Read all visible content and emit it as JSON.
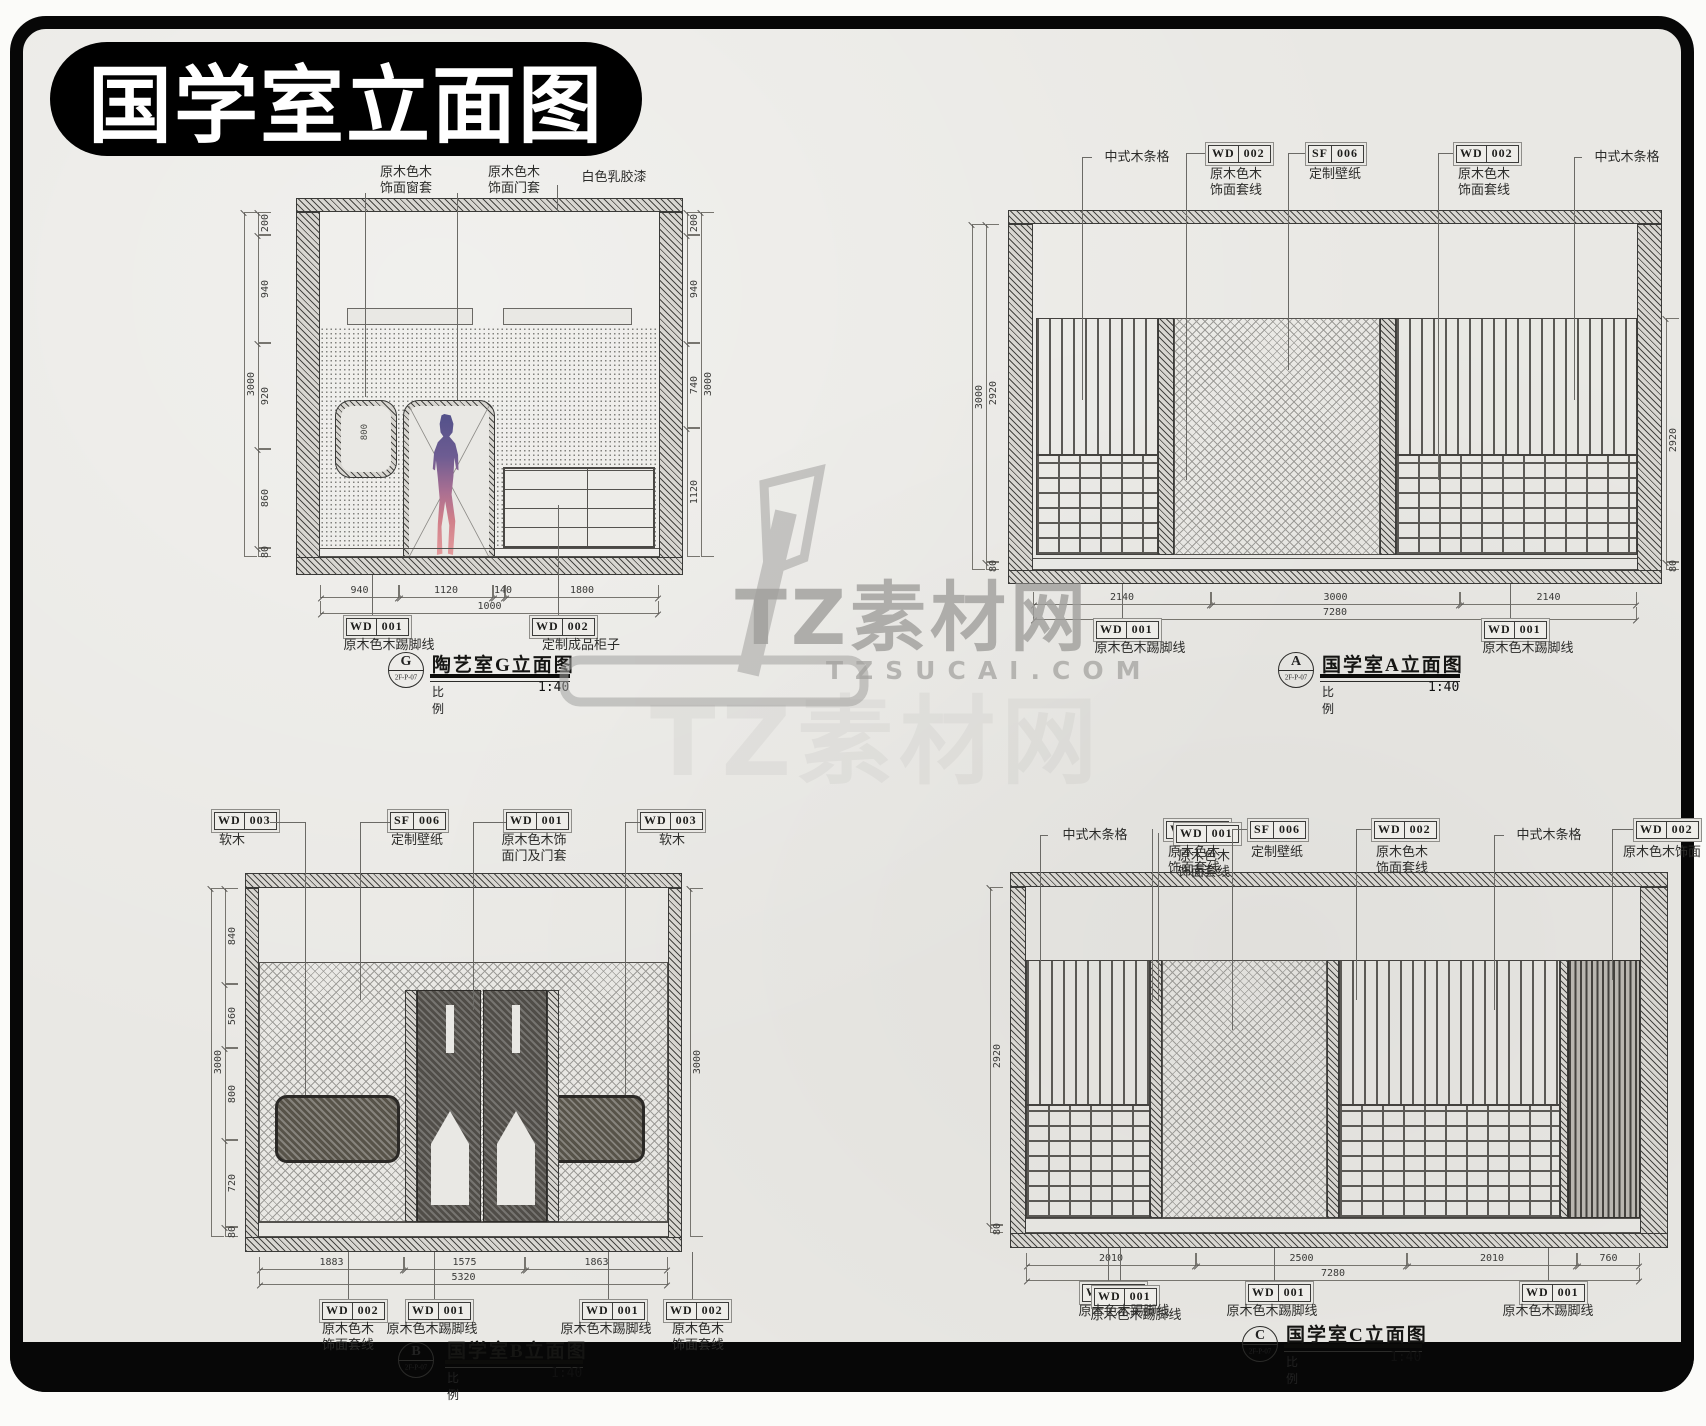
{
  "banner": {
    "title": "国学室立面图"
  },
  "watermark": {
    "brand": "TZ素材网",
    "domain": "TZSUCAI.COM"
  },
  "drawings": {
    "g": {
      "top_labels": [
        {
          "name": "原木色木\n饰面窗套"
        },
        {
          "name": "原木色木\n饰面门套"
        },
        {
          "name": "白色乳胶漆"
        }
      ],
      "window_dim": "800",
      "dims_left": [
        "200",
        "940",
        "920",
        "860",
        "80"
      ],
      "dims_left_total": "3000",
      "dims_right": [
        "200",
        "940",
        "740",
        "1120"
      ],
      "dims_right_total": "3000",
      "dims_bottom": [
        "940",
        "1120",
        "140",
        "1800"
      ],
      "dims_bottom_total": "1000",
      "tags_bottom": [
        {
          "code": "WD",
          "num": "001",
          "name": "原木色木踢脚线"
        },
        {
          "code": "WD",
          "num": "002",
          "name": "定制成品柜子"
        }
      ],
      "title": {
        "sym": "G",
        "ref": "2F-P-07",
        "name": "陶艺室G立面图",
        "scale_label": "比例",
        "scale": "1:40"
      }
    },
    "a": {
      "top_labels": [
        {
          "name": "中式木条格"
        },
        {
          "code": "WD",
          "num": "002",
          "name": "原木色木\n饰面套线"
        },
        {
          "code": "SF",
          "num": "006",
          "name": "定制壁纸"
        },
        {
          "code": "WD",
          "num": "002",
          "name": "原木色木\n饰面套线"
        },
        {
          "name": "中式木条格"
        }
      ],
      "dims_left": [
        "2920",
        "80"
      ],
      "dims_left_total": "3000",
      "dims_right": [
        "2920",
        "80"
      ],
      "dims_bottom": [
        "2140",
        "3000",
        "2140"
      ],
      "dims_bottom_total": "7280",
      "tags_bottom": [
        {
          "code": "WD",
          "num": "001",
          "name": "原木色木踢脚线"
        },
        {
          "code": "WD",
          "num": "001",
          "name": "原木色木踢脚线"
        }
      ],
      "title": {
        "sym": "A",
        "ref": "2F-P-07",
        "name": "国学室A立面图",
        "scale_label": "比例",
        "scale": "1:40"
      }
    },
    "b": {
      "top_labels": [
        {
          "code": "WD",
          "num": "003",
          "name": "软木"
        },
        {
          "code": "SF",
          "num": "006",
          "name": "定制壁纸"
        },
        {
          "code": "WD",
          "num": "001",
          "name": "原木色木饰\n面门及门套"
        },
        {
          "code": "WD",
          "num": "003",
          "name": "软木"
        }
      ],
      "dims_left": [
        "840",
        "560",
        "800",
        "720",
        "80"
      ],
      "dims_left_total": "3000",
      "dims_right_total": "3000",
      "dims_bottom": [
        "1883",
        "1575",
        "1863"
      ],
      "dims_bottom_total": "5320",
      "tags_bottom": [
        {
          "code": "WD",
          "num": "002",
          "name": "原木色木\n饰面套线"
        },
        {
          "code": "WD",
          "num": "001",
          "name": "原木色木踢脚线"
        },
        {
          "code": "WD",
          "num": "001",
          "name": "原木色木踢脚线"
        },
        {
          "code": "WD",
          "num": "002",
          "name": "原木色木\n饰面套线"
        }
      ],
      "title": {
        "sym": "B",
        "ref": "2F-P-07",
        "name": "国学室B立面图",
        "scale_label": "比例",
        "scale": "1:40"
      }
    },
    "c": {
      "top_labels": [
        {
          "name": "中式木条格"
        },
        {
          "code": "WD",
          "num": "002",
          "name": "原木色木\n饰面套线"
        },
        {
          "code": "WD",
          "num": "001",
          "name": "原木色木\n饰面套线"
        },
        {
          "code": "SF",
          "num": "006",
          "name": "定制壁纸"
        },
        {
          "code": "WD",
          "num": "002",
          "name": "原木色木\n饰面套线"
        },
        {
          "name": "中式木条格"
        },
        {
          "code": "WD",
          "num": "002",
          "name": "原木色木饰面"
        }
      ],
      "dims_left": [
        "2920",
        "80"
      ],
      "dims_bottom": [
        "2010",
        "2500",
        "2010",
        "760"
      ],
      "dims_bottom_total": "7280",
      "tags_bottom": [
        {
          "code": "WD",
          "num": "001",
          "name": "原木色木踢脚线"
        },
        {
          "code": "WD",
          "num": "001",
          "name": "原木色木踢脚线"
        },
        {
          "code": "WD",
          "num": "001",
          "name": "原木色木踢脚线"
        },
        {
          "code": "WD",
          "num": "001",
          "name": "原木色木踢脚线"
        }
      ],
      "title": {
        "sym": "C",
        "ref": "2F-P-07",
        "name": "国学室C立面图",
        "scale_label": "比例",
        "scale": "1:40"
      }
    }
  }
}
